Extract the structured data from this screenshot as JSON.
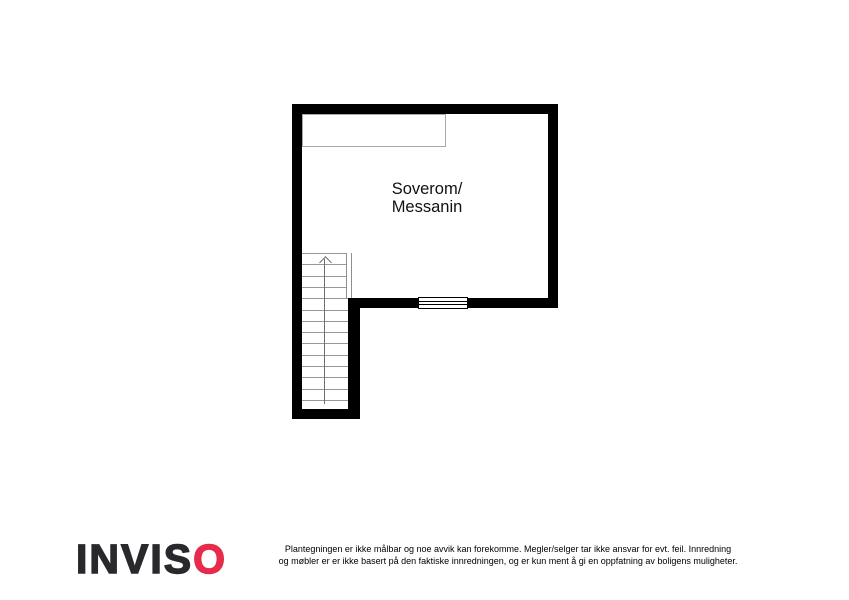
{
  "floorplan": {
    "room_label_line1": "Soverom/",
    "room_label_line2": "Messanin",
    "stairs": {
      "tread_count": 13,
      "direction": "up"
    },
    "features": {
      "closet_outline": "unlabeled thin-line rectangle along top wall",
      "opening_symbol": "railing/opening in bottom wall"
    }
  },
  "footer": {
    "logo_text_dark": "INVIS",
    "logo_text_red": "O",
    "disclaimer_line1": "Plantegningen er ikke målbar og noe avvik kan forekomme. Megler/selger tar ikke ansvar for evt. feil. Innredning",
    "disclaimer_line2": "og møbler er er ikke basert på den faktiske innredningen, og er kun ment å gi en oppfatning av boligens muligheter."
  },
  "colors": {
    "wall": "#000000",
    "stair_lines": "#979797",
    "closet_outline": "#a8a8a8",
    "logo_dark": "#29292d",
    "logo_red": "#e62b4b",
    "background": "#ffffff"
  }
}
